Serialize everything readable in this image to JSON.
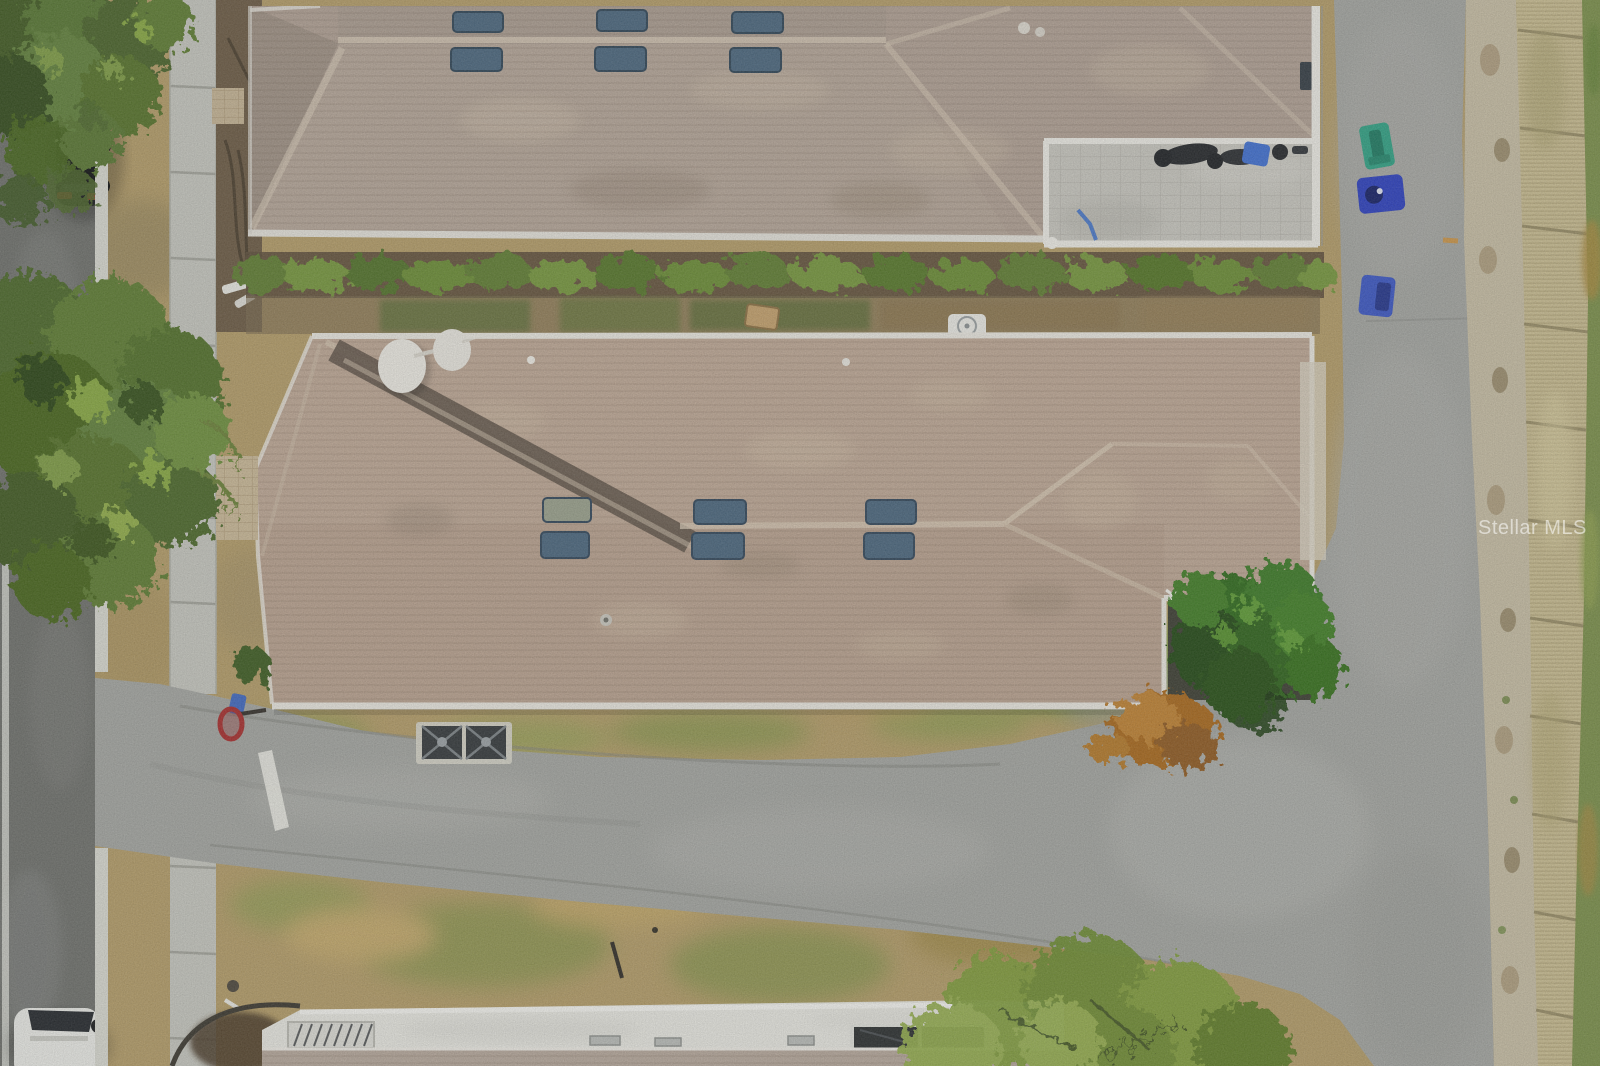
{
  "scene": {
    "label": "Overhead aerial drone photo of a residential street: three single-story shingle-roof homes, a side-street intersection, sidewalks, parked cars, trash bins and a wooden privacy fence along the right edge"
  },
  "watermark": {
    "text": "Stellar MLS",
    "color": "#ffffff"
  },
  "palette": {
    "lawn_dry": "#b39c68",
    "lawn_green": "#8f9a52",
    "street_left_asphalt": "#6e706c",
    "road_asphalt": "#a3a5a1",
    "sidewalk_concrete": "#c5c6bf",
    "curb_white": "#d8d9d1",
    "road_marking_white": "#e9e9e3",
    "roof_shingle_top_house": "#b0a094",
    "roof_shingle_middle_house": "#bda795",
    "roof_valley_dark": "#5f5348",
    "roof_white_lanai": "#e7e7e1",
    "skylight_blue": "#4a667e",
    "skylight_sage": "#99a08c",
    "satellite_dish_white": "#eceae3",
    "patio_pavers": "#c7c6bf",
    "mulch_dark": "#6b5a44",
    "shrub_green": "#5e7d30",
    "tree_canopy_green": "#55722c",
    "lush_tree_green": "#2f6b1f",
    "dry_bush_orange": "#a8681f",
    "gravel_strip": "#c6bda4",
    "fence_wood_tan": "#c9bd92",
    "grass_right_green": "#7a8f4a",
    "trash_bin_green": "#2fa184",
    "recycle_bin_blue": "#2b3fbf",
    "bin_blue_2": "#3a56c4",
    "stop_sign_red": "#a62c2c",
    "basketball_base_blue": "#3f68c0",
    "ac_unit_dark": "#33383b",
    "car_black": "#17191c",
    "car_white": "#e9eae6"
  }
}
